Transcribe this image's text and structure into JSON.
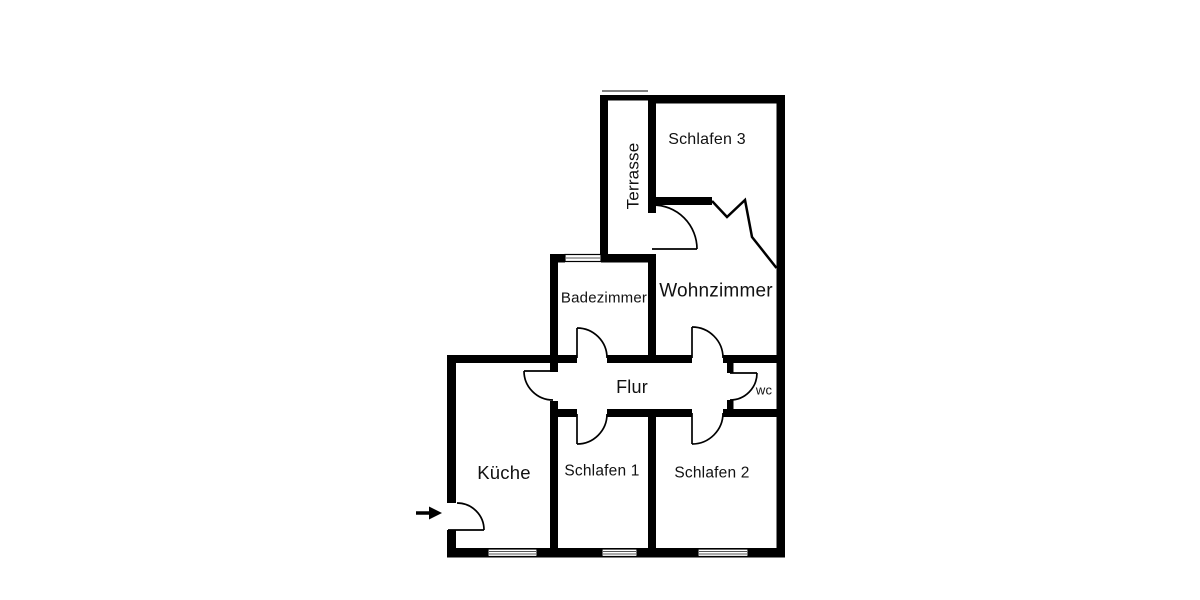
{
  "floorplan": {
    "kind": "apartment-floor-plan",
    "rooms": [
      {
        "id": "schlafen3",
        "label": "Schlafen 3"
      },
      {
        "id": "terrasse",
        "label": "Terrasse"
      },
      {
        "id": "badezimmer",
        "label": "Badezimmer"
      },
      {
        "id": "wohnzimmer",
        "label": "Wohnzimmer"
      },
      {
        "id": "flur",
        "label": "Flur"
      },
      {
        "id": "wc",
        "label": "wc"
      },
      {
        "id": "kueche",
        "label": "Küche"
      },
      {
        "id": "schlafen1",
        "label": "Schlafen 1"
      },
      {
        "id": "schlafen2",
        "label": "Schlafen 2"
      }
    ],
    "icons": {
      "entrance_arrow": "right-arrow"
    },
    "colors": {
      "wall": "#000000",
      "background": "#ffffff",
      "window_fill": "#ffffff",
      "window_stripe": "#555555"
    }
  }
}
